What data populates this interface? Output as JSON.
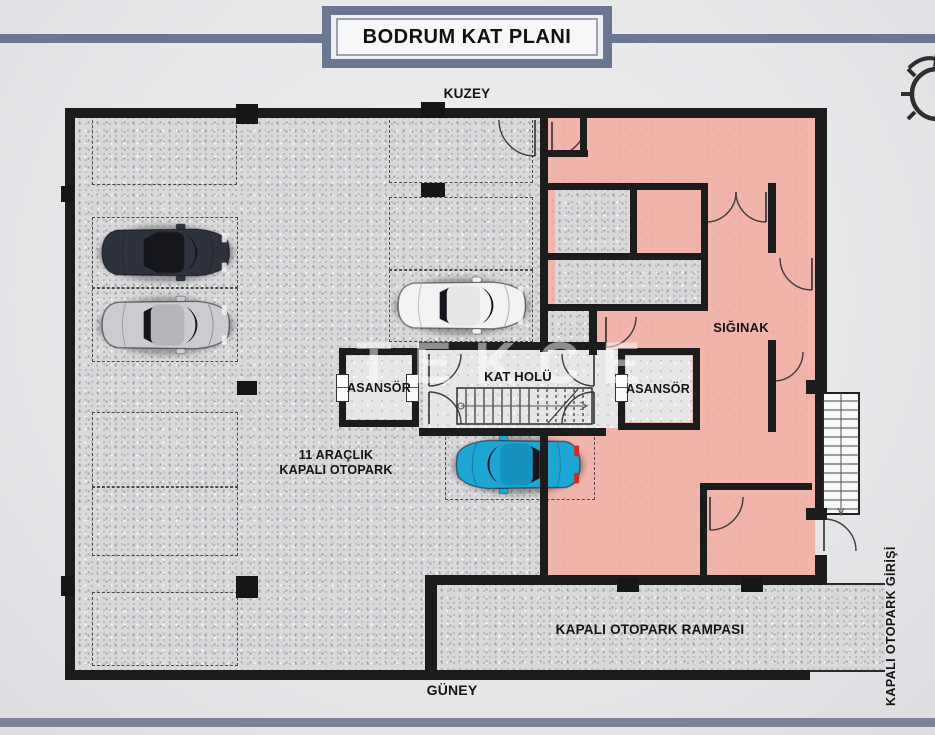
{
  "header": {
    "title": "BODRUM KAT PLANI",
    "north_label": "KUZEY"
  },
  "footer": {
    "south_label": "GÜNEY"
  },
  "plan": {
    "watermark": "TEKCE",
    "labels": {
      "elevator_left": "ASANSÖR",
      "elevator_right": "ASANSÖR",
      "floor_hall": "KAT HOLÜ",
      "shelter": "SIĞINAK",
      "parking_line1": "11 ARAÇLIK",
      "parking_line2": "KAPALI OTOPARK",
      "ramp": "KAPALI OTOPARK RAMPASI",
      "garage_entrance": "KAPALI OTOPARK GİRİŞİ"
    },
    "colors": {
      "wall": "#1c1c1c",
      "shelter_pink": "#f0b4ab",
      "accent_frame": "#6b7693",
      "footer_bar": "#7b8398",
      "car_dark_body": "#2e323d",
      "car_dark_roof": "#15171d",
      "car_silver_body": "#cbccd0",
      "car_silver_roof": "#b4b5ba",
      "car_white_body": "#f3f3f4",
      "car_white_roof": "#e7e7ea",
      "car_teal_body": "#1da5d4",
      "car_teal_roof": "#1791bd",
      "glass_dark": "#14161b",
      "taillight_red": "#d42b1f"
    }
  }
}
